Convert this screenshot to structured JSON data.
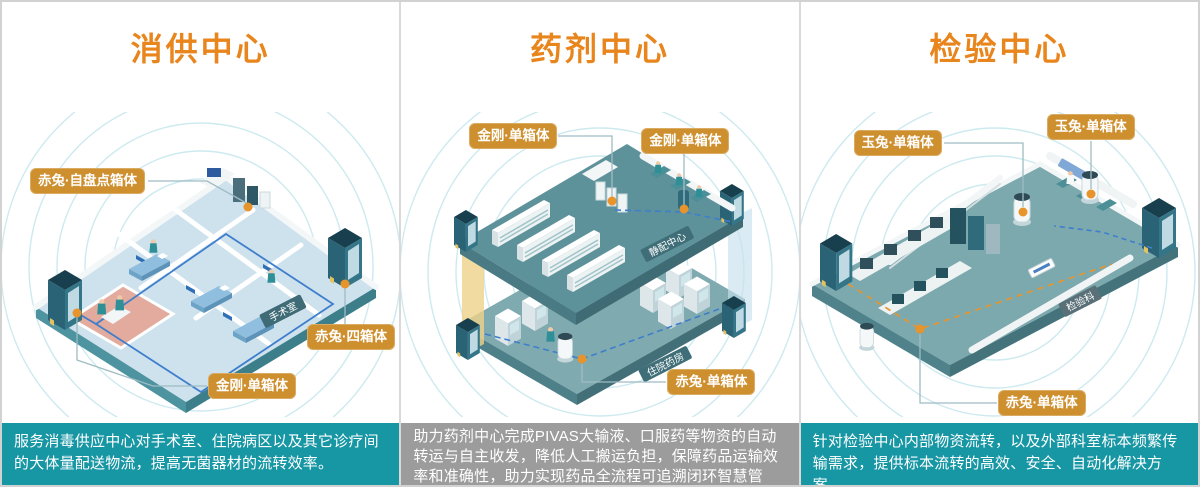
{
  "page": {
    "background": "#ffffff",
    "border_color": "#d2d2d2"
  },
  "colors": {
    "title_orange": "#E8861D",
    "badge_gold": "#CE8F2E",
    "caption_teal": "#1796A4",
    "caption_gray": "#9C9C9C",
    "path_blue": "#3E7ECC",
    "path_orange": "#E8942C",
    "ripple_blue": "#CDEAF0",
    "floor_teal": "#7CA9AE",
    "cabinet_dark_teal": "#2A6375"
  },
  "panels": [
    {
      "id": "supply-center",
      "title": "消供中心",
      "badges": [
        {
          "text": "赤兔·自盘点箱体"
        },
        {
          "text": "赤兔·四箱体"
        },
        {
          "text": "金刚·单箱体"
        }
      ],
      "signs": [
        "手术室"
      ],
      "caption": "服务消毒供应中心对手术室、住院病区以及其它诊疗间的大体量配送物流，提高无菌器材的流转效率。",
      "caption_bg": "#1796A4"
    },
    {
      "id": "pharmacy-center",
      "title": "药剂中心",
      "badges": [
        {
          "text": "金刚·单箱体"
        },
        {
          "text": "金刚·单箱体"
        },
        {
          "text": "赤兔·单箱体"
        }
      ],
      "signs": [
        "静配中心",
        "住院药房"
      ],
      "caption": "助力药剂中心完成PIVAS大输液、口服药等物资的自动转运与自主收发，降低人工搬运负担，保障药品运输效率和准确性，助力实现药品全流程可追溯闭环智慧管理。",
      "caption_bg": "#9C9C9C"
    },
    {
      "id": "lab-center",
      "title": "检验中心",
      "badges": [
        {
          "text": "玉兔·单箱体"
        },
        {
          "text": "玉兔·单箱体"
        },
        {
          "text": "赤兔·单箱体"
        }
      ],
      "signs": [
        "检验科"
      ],
      "caption": "针对检验中心内部物资流转，以及外部科室标本频繁传输需求，提供标本流转的高效、安全、自动化解决方案。",
      "caption_bg": "#1796A4"
    }
  ]
}
